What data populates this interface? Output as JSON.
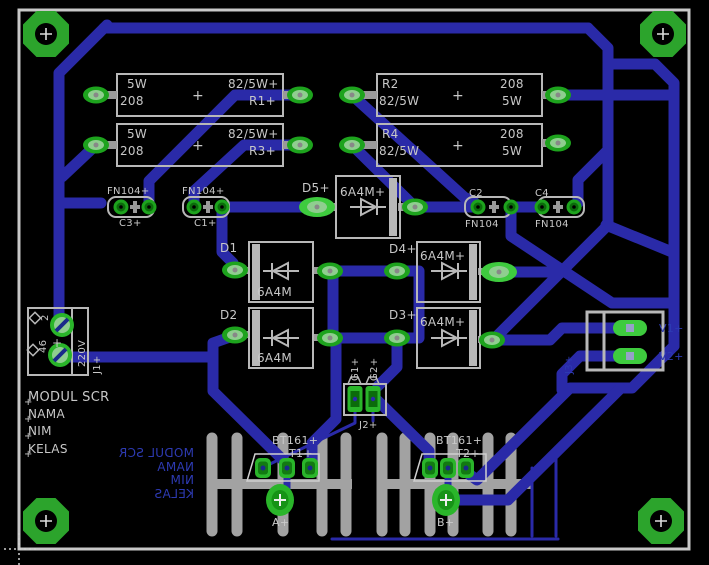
{
  "app": {
    "view": "pcb-board-layout",
    "board_name": "MODUL SCR"
  },
  "colors": {
    "background": "#000000",
    "trace_blue": "#2a2aa8",
    "silk_gray": "#c8c8c8",
    "outline_gray": "#b8b8b8",
    "heatsink_gray": "#a2a2a2",
    "pad_green": "#1da31d",
    "pad_green_bright": "#3ecb3e",
    "pad_inner_light": "#8fce8f",
    "pad_inner_dark": "#0b6b0b",
    "hole_green": "#2ca42c",
    "bottom_text_blue": "#2d3ab2",
    "drill_navy": "#1a2a8a"
  },
  "components": {
    "resistors": [
      "R1",
      "R2",
      "R3",
      "R4"
    ],
    "diodes": [
      "D1",
      "D2",
      "D3",
      "D4",
      "D5"
    ],
    "capacitors": [
      "C1",
      "C2",
      "C3",
      "C4"
    ],
    "connectors": [
      "J1",
      "J2",
      "J3"
    ],
    "thyristors": [
      "T1",
      "T2"
    ],
    "resistor_values": [
      "5W 208",
      "82/5W"
    ],
    "diode_value": "6A4M",
    "capacitor_value": "FN104",
    "thyristor_value": "BT161",
    "mains_label": "220V"
  },
  "texts": [
    {
      "name": "r1-pair-value-l1",
      "t": "5W",
      "x": 127,
      "y": 88,
      "s": 12
    },
    {
      "name": "r1-pair-value-l2",
      "t": "208",
      "x": 120,
      "y": 105,
      "s": 12
    },
    {
      "name": "r1-origin-cross",
      "t": "+",
      "x": 192,
      "y": 100,
      "s": 14
    },
    {
      "name": "r1-value",
      "t": "82/5W+",
      "x": 228,
      "y": 88,
      "s": 12
    },
    {
      "name": "r1-ref",
      "t": "R1+",
      "x": 249,
      "y": 105,
      "s": 12
    },
    {
      "name": "r3-pair-value-l1",
      "t": "5W",
      "x": 127,
      "y": 138,
      "s": 12
    },
    {
      "name": "r3-pair-value-l2",
      "t": "208",
      "x": 120,
      "y": 155,
      "s": 12
    },
    {
      "name": "r3-origin-cross",
      "t": "+",
      "x": 192,
      "y": 150,
      "s": 14
    },
    {
      "name": "r3-value",
      "t": "82/5W+",
      "x": 228,
      "y": 138,
      "s": 12
    },
    {
      "name": "r3-ref",
      "t": "R3+",
      "x": 249,
      "y": 155,
      "s": 12
    },
    {
      "name": "r2-ref",
      "t": "R2",
      "x": 382,
      "y": 88,
      "s": 12
    },
    {
      "name": "r2-value",
      "t": "82/5W",
      "x": 379,
      "y": 105,
      "s": 12
    },
    {
      "name": "r2-origin-cross",
      "t": "+",
      "x": 452,
      "y": 100,
      "s": 14
    },
    {
      "name": "r2-pair-value-l1",
      "t": "208",
      "x": 500,
      "y": 88,
      "s": 12
    },
    {
      "name": "r2-pair-value-l2",
      "t": "5W",
      "x": 502,
      "y": 105,
      "s": 12
    },
    {
      "name": "r4-ref",
      "t": "R4",
      "x": 382,
      "y": 138,
      "s": 12
    },
    {
      "name": "r4-value",
      "t": "82/5W",
      "x": 379,
      "y": 155,
      "s": 12
    },
    {
      "name": "r4-origin-cross",
      "t": "+",
      "x": 452,
      "y": 150,
      "s": 14
    },
    {
      "name": "r4-pair-value-l1",
      "t": "208",
      "x": 500,
      "y": 138,
      "s": 12
    },
    {
      "name": "r4-pair-value-l2",
      "t": "5W",
      "x": 502,
      "y": 155,
      "s": 12
    },
    {
      "name": "c3-value",
      "t": "FN104+",
      "x": 107,
      "y": 194,
      "s": 10
    },
    {
      "name": "c3-ref",
      "t": "C3+",
      "x": 119,
      "y": 226,
      "s": 10
    },
    {
      "name": "c1-value",
      "t": "FN104+",
      "x": 182,
      "y": 194,
      "s": 10
    },
    {
      "name": "c1-ref",
      "t": "C1+",
      "x": 194,
      "y": 226,
      "s": 10
    },
    {
      "name": "c2-ref",
      "t": "C2",
      "x": 469,
      "y": 196,
      "s": 10
    },
    {
      "name": "c2-value",
      "t": "FN104",
      "x": 465,
      "y": 227,
      "s": 10
    },
    {
      "name": "c4-ref",
      "t": "C4",
      "x": 535,
      "y": 196,
      "s": 10
    },
    {
      "name": "c4-value",
      "t": "FN104",
      "x": 535,
      "y": 227,
      "s": 10
    },
    {
      "name": "d5-ref",
      "t": "D5+",
      "x": 302,
      "y": 192,
      "s": 12
    },
    {
      "name": "d5-value",
      "t": "6A4M+",
      "x": 340,
      "y": 196,
      "s": 12
    },
    {
      "name": "d1-ref",
      "t": "D1",
      "x": 220,
      "y": 252,
      "s": 12
    },
    {
      "name": "d1-value",
      "t": "6A4M",
      "x": 257,
      "y": 296,
      "s": 12
    },
    {
      "name": "d2-ref",
      "t": "D2",
      "x": 220,
      "y": 319,
      "s": 12
    },
    {
      "name": "d2-value",
      "t": "6A4M",
      "x": 257,
      "y": 362,
      "s": 12
    },
    {
      "name": "d4-ref",
      "t": "D4+",
      "x": 389,
      "y": 253,
      "s": 12
    },
    {
      "name": "d4-value",
      "t": "6A4M+",
      "x": 420,
      "y": 260,
      "s": 12
    },
    {
      "name": "d3-ref",
      "t": "D3+",
      "x": 389,
      "y": 319,
      "s": 12
    },
    {
      "name": "d3-value",
      "t": "6A4M+",
      "x": 420,
      "y": 326,
      "s": 12
    },
    {
      "name": "silk-title",
      "t": "MODUL SCR",
      "x": 28,
      "y": 401,
      "s": 13
    },
    {
      "name": "silk-nama",
      "t": "NAMA",
      "x": 28,
      "y": 418,
      "s": 12
    },
    {
      "name": "silk-nim",
      "t": "NIM",
      "x": 28,
      "y": 435,
      "s": 12
    },
    {
      "name": "silk-kelas",
      "t": "KELAS",
      "x": 28,
      "y": 453,
      "s": 12
    },
    {
      "name": "silk-title-cross",
      "t": "+",
      "x": 24,
      "y": 405,
      "s": 10
    },
    {
      "name": "silk-nama-cross",
      "t": "+",
      "x": 24,
      "y": 422,
      "s": 10
    },
    {
      "name": "silk-nim-cross",
      "t": "+",
      "x": 24,
      "y": 439,
      "s": 10
    },
    {
      "name": "silk-kelas-cross",
      "t": "+",
      "x": 24,
      "y": 457,
      "s": 10
    },
    {
      "name": "t1-value",
      "t": "BT161+",
      "x": 272,
      "y": 444,
      "s": 11
    },
    {
      "name": "t1-ref",
      "t": "T1+",
      "x": 289,
      "y": 457,
      "s": 11
    },
    {
      "name": "t2-value",
      "t": "BT161+",
      "x": 436,
      "y": 444,
      "s": 11
    },
    {
      "name": "t2-ref",
      "t": "T2+",
      "x": 456,
      "y": 457,
      "s": 11
    },
    {
      "name": "pad-a-label",
      "t": "A+",
      "x": 272,
      "y": 526,
      "s": 11
    },
    {
      "name": "pad-b-label",
      "t": "B+",
      "x": 437,
      "y": 526,
      "s": 11
    },
    {
      "name": "j2-ref",
      "t": "J2+",
      "x": 359,
      "y": 428,
      "s": 10
    },
    {
      "name": "j2-pin-g1",
      "t": "G1+",
      "x": 358,
      "y": 381,
      "s": 10,
      "r": 1
    },
    {
      "name": "j2-pin-g2",
      "t": "G2+",
      "x": 377,
      "y": 381,
      "s": 10,
      "r": 1
    },
    {
      "name": "j1-ref",
      "t": "J1+",
      "x": 100,
      "y": 374,
      "s": 10,
      "r": 1
    },
    {
      "name": "j1-value",
      "t": "220V",
      "x": 85,
      "y": 367,
      "s": 10,
      "r": 1
    },
    {
      "name": "j1-pin-2",
      "t": "2",
      "x": 48,
      "y": 321,
      "s": 10,
      "r": 1
    },
    {
      "name": "j1-pin-1",
      "t": "46",
      "x": 46,
      "y": 353,
      "s": 10,
      "r": 1
    },
    {
      "name": "j1-origin-cross",
      "t": "+",
      "x": 52,
      "y": 347,
      "s": 12
    },
    {
      "name": "j3-pin-v1",
      "t": "V1+",
      "x": 659,
      "y": 332,
      "s": 11,
      "c": "blue"
    },
    {
      "name": "j3-pin-v2",
      "t": "V2+",
      "x": 659,
      "y": 360,
      "s": 11,
      "c": "blue"
    },
    {
      "name": "j3-ref",
      "t": "J3+",
      "x": 572,
      "y": 374,
      "s": 10,
      "r": 1,
      "c": "blue"
    },
    {
      "name": "bottom-title-mirrored",
      "t": "MODUL SCR",
      "x": 194,
      "y": 457,
      "s": 12,
      "c": "blue",
      "m": 1
    },
    {
      "name": "bottom-nama-mirrored",
      "t": "NAMA",
      "x": 194,
      "y": 471,
      "s": 12,
      "c": "blue",
      "m": 1
    },
    {
      "name": "bottom-nim-mirrored",
      "t": "NIM",
      "x": 194,
      "y": 484,
      "s": 12,
      "c": "blue",
      "m": 1
    },
    {
      "name": "bottom-kelas-mirrored",
      "t": "KELAS",
      "x": 194,
      "y": 498,
      "s": 12,
      "c": "blue",
      "m": 1
    }
  ]
}
